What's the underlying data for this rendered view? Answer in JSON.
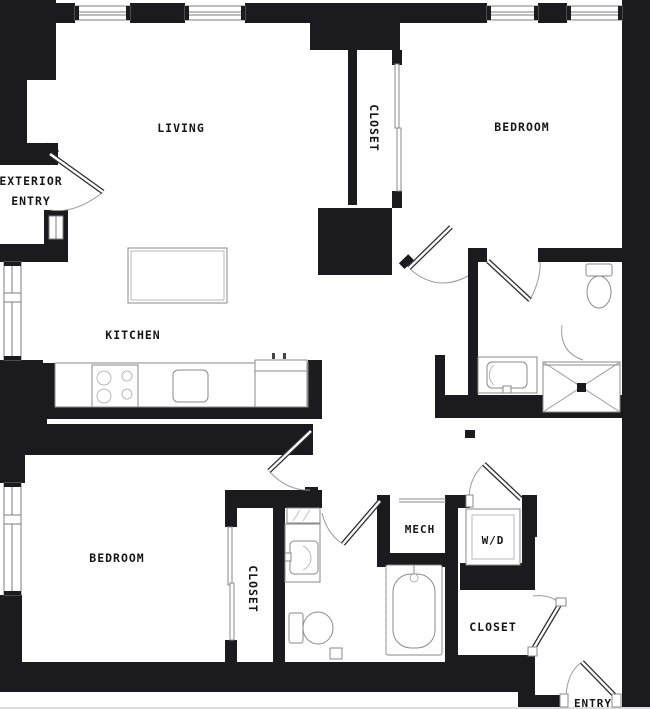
{
  "plan": {
    "title": "apartment-floor-plan",
    "labels": {
      "living": "LIVING",
      "kitchen": "KITCHEN",
      "exterior_entry_line1": "EXTERIOR",
      "exterior_entry_line2": "ENTRY",
      "closet_top": "CLOSET",
      "bedroom_top": "BEDROOM",
      "bedroom_bottom": "BEDROOM",
      "closet_bottom": "CLOSET",
      "mech": "MECH",
      "washer_dryer": "W/D",
      "closet_entry": "CLOSET",
      "entry": "ENTRY"
    },
    "colors": {
      "wall": "#1b1b1f",
      "fixture_line": "#8a8a8a",
      "door_arc": "#9b9b9b",
      "text": "#161616",
      "background": "#ffffff"
    }
  }
}
